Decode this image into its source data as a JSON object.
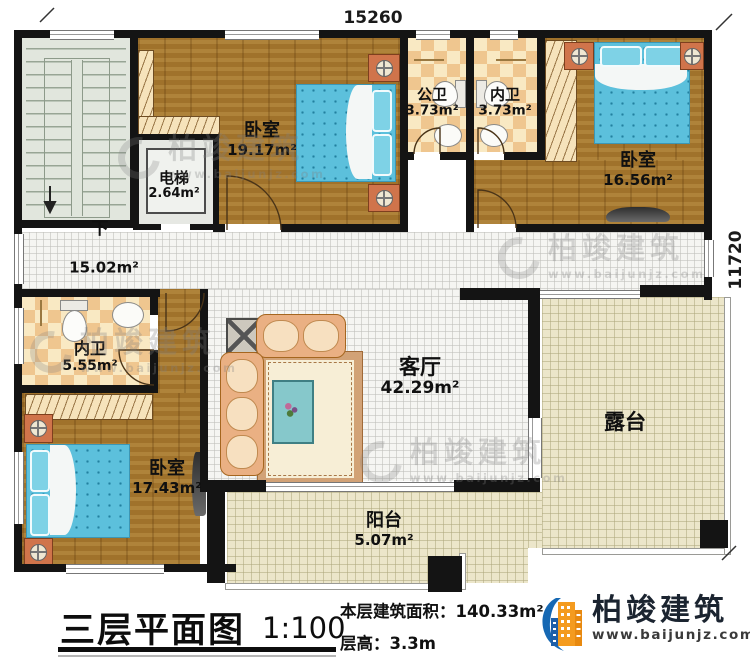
{
  "dimensions": {
    "top": "15260",
    "right": "11720"
  },
  "rooms": {
    "stair": {
      "direction_label": "下"
    },
    "hall": {
      "area": "15.02m²"
    },
    "elevator": {
      "name": "电梯",
      "area": "2.64m²"
    },
    "bedroom_top_left": {
      "name": "卧室",
      "area": "19.17m²"
    },
    "public_bath": {
      "name": "公卫",
      "area": "3.73m²"
    },
    "inner_bath_top": {
      "name": "内卫",
      "area": "3.73m²"
    },
    "bedroom_top_right": {
      "name": "卧室",
      "area": "16.56m²"
    },
    "inner_bath_left": {
      "name": "内卫",
      "area": "5.55m²"
    },
    "bedroom_bottom_left": {
      "name": "卧室",
      "area": "17.43m²"
    },
    "living_room": {
      "name": "客厅",
      "area": "42.29m²"
    },
    "terrace": {
      "name": "露台"
    },
    "balcony": {
      "name": "阳台",
      "area": "5.07m²"
    }
  },
  "watermark": {
    "brand": "柏竣建筑",
    "site": "www.baijunjz.com"
  },
  "title_block": {
    "drawing_title": "三层平面图",
    "scale": "1:100",
    "floor_area": "本层建筑面积：140.33m²",
    "floor_height": "层高：3.3m",
    "brand": "柏竣建筑",
    "website": "www.baijunjz.com"
  }
}
